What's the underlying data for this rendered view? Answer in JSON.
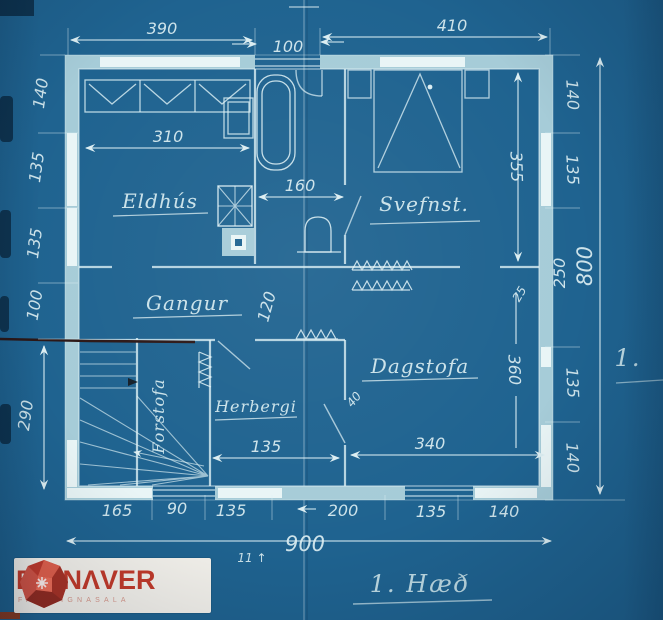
{
  "document": {
    "type": "blueprint floor plan (cyanotype scan)",
    "caption": "1. Hæð",
    "sheet_note": "1.",
    "pencil_note": "11 ↑"
  },
  "colors": {
    "paper_blue": "#1f6390",
    "wall_fill": "#a6ccd8",
    "window_fill": "#e9f5f6",
    "line": "#dceef2",
    "pencil_dark": "#2c1716",
    "logo_red": "#c23a2a",
    "logo_sub_red": "#d89a8d",
    "logo_bg": "#f4f2ec"
  },
  "rooms": {
    "kitchen": "Eldhús",
    "bedroom": "Svefnst.",
    "hall": "Gangur",
    "living": "Dagstofa",
    "room": "Herbergi",
    "entry": "Forstofa"
  },
  "dims": {
    "top": [
      "390",
      "100",
      "410"
    ],
    "left": [
      "140",
      "135",
      "135",
      "100",
      "290"
    ],
    "right": [
      "140",
      "135",
      "250",
      "135",
      "140"
    ],
    "right_total": "800",
    "bottom": [
      "165",
      "90",
      "135",
      "200",
      "135",
      "140"
    ],
    "bottom_total": "900",
    "interior": {
      "kitchen_w": "310",
      "bath_w": "160",
      "bedroom_h": "355",
      "living_h": "360",
      "living_w": "340",
      "room_w": "135",
      "hall_mark": "120",
      "small_40": "40",
      "small_25": "25"
    }
  },
  "logo": {
    "name": "EIGNΛVER",
    "subtitle": "FASTEIGNASALA"
  }
}
